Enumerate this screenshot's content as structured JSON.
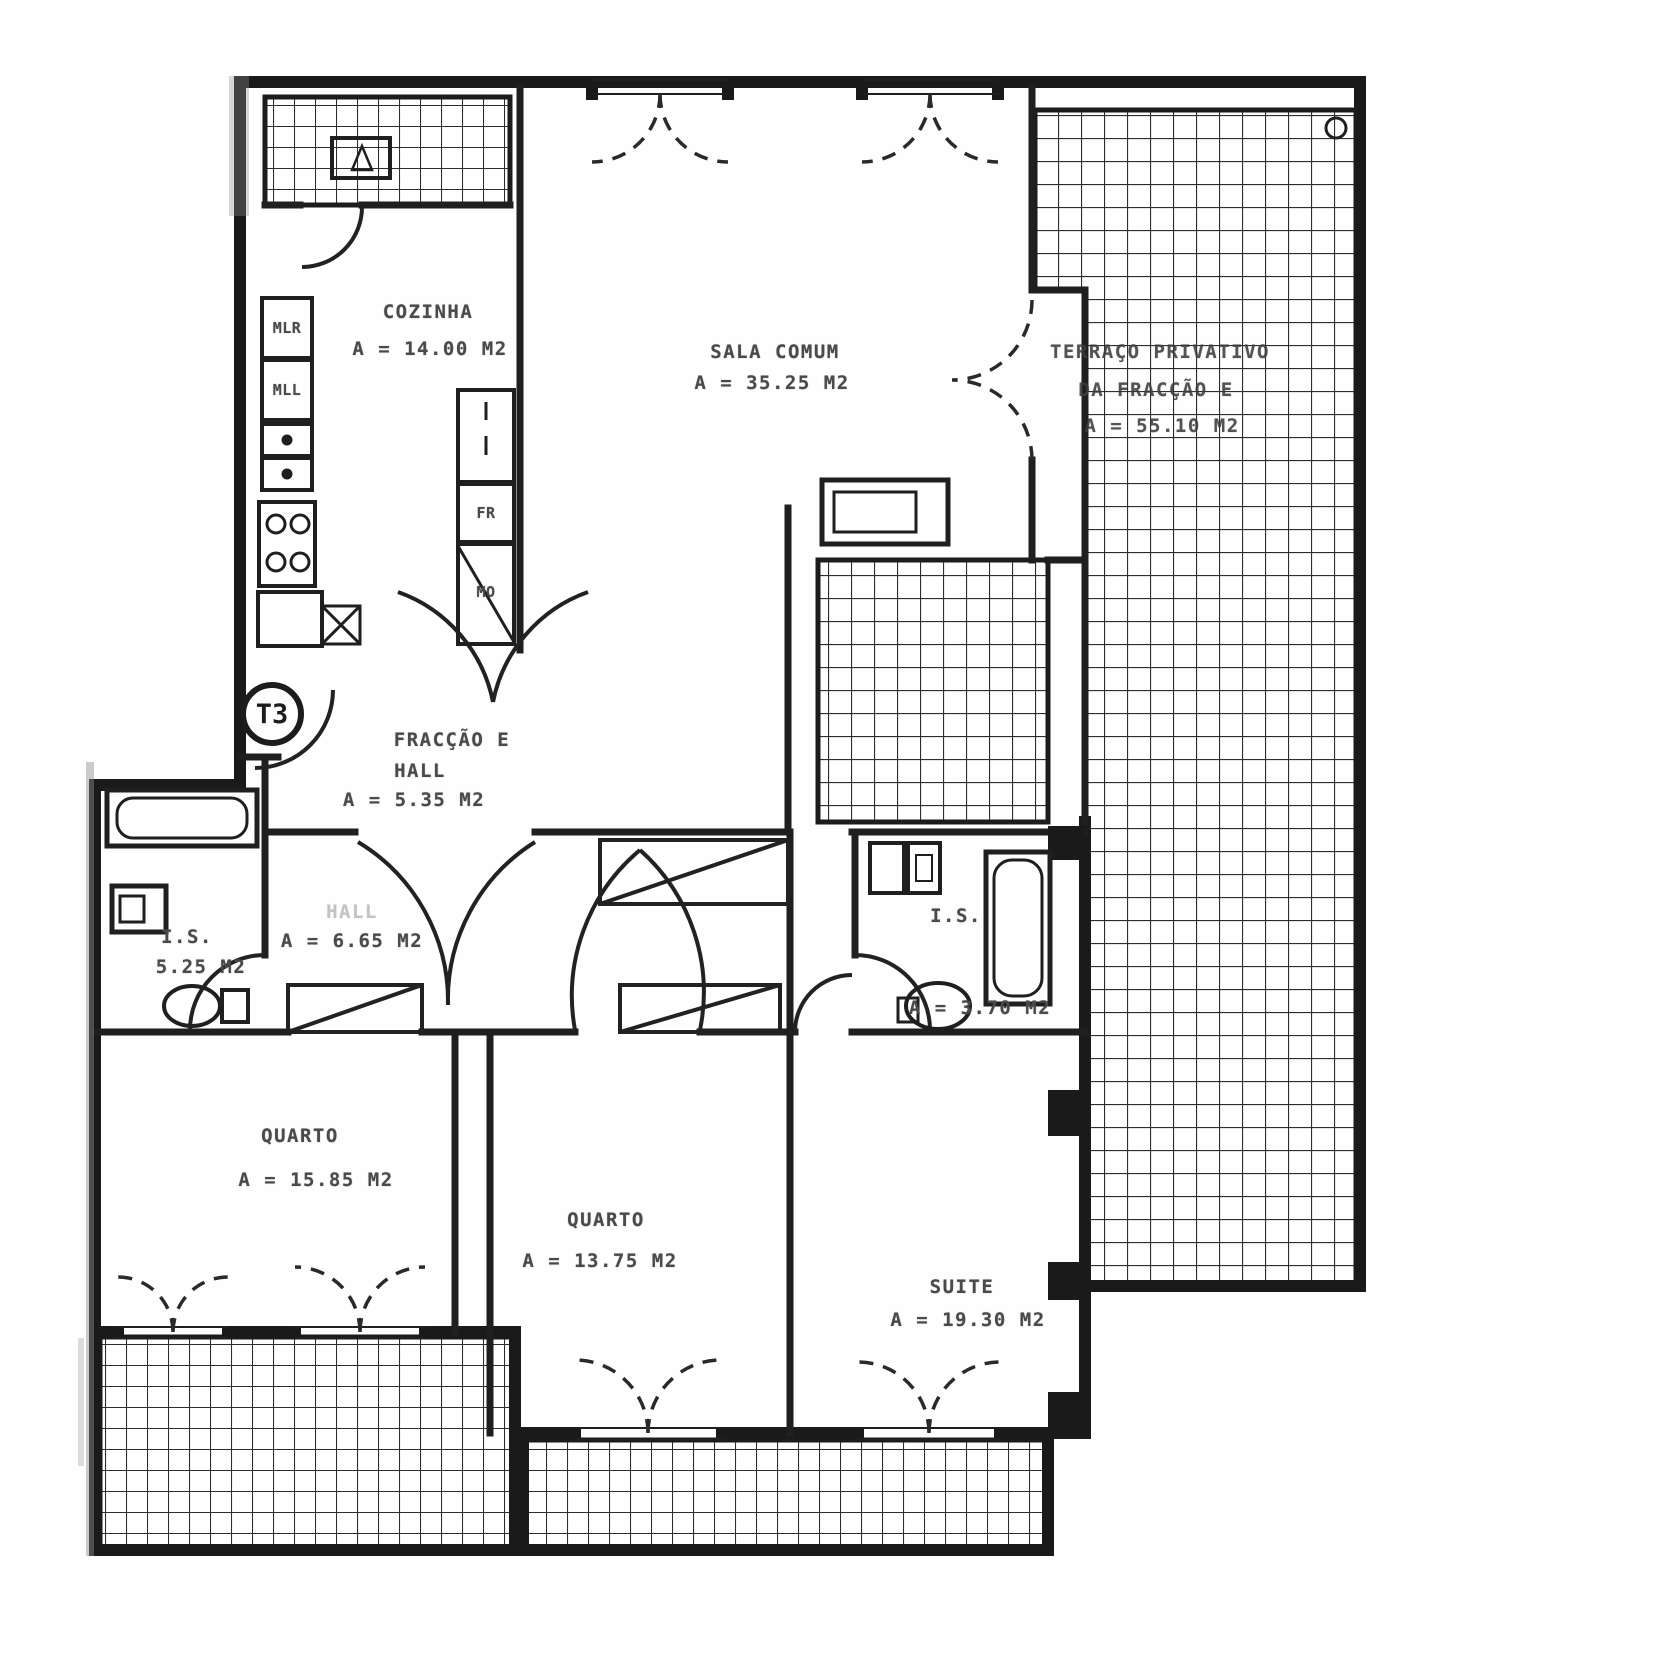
{
  "plan": {
    "badge": "T3",
    "rooms": {
      "cozinha": {
        "name": "COZINHA",
        "area": "A = 14.00 M2"
      },
      "sala": {
        "name": "SALA COMUM",
        "area": "A = 35.25 M2"
      },
      "terraco": {
        "name": "TERRAÇO PRIVATIVO",
        "name2": "DA FRACÇÃO E",
        "area": "A = 55.10 M2"
      },
      "fraccao": {
        "name": "FRACÇÃO E",
        "name2": "HALL",
        "area": "A = 5.35 M2"
      },
      "hall": {
        "name": "HALL",
        "area": "A = 6.65 M2"
      },
      "is_esq": {
        "name": "I.S.",
        "area": "5.25 M2"
      },
      "is_dir": {
        "name": "I.S.",
        "area": "A = 3.70 M2"
      },
      "quarto1": {
        "name": "QUARTO",
        "area": "A = 15.85 M2"
      },
      "quarto2": {
        "name": "QUARTO",
        "area": "A = 13.75 M2"
      },
      "suite": {
        "name": "SUITE",
        "area": "A = 19.30 M2"
      }
    },
    "appliances": {
      "mlr": "MLR",
      "mll": "MLL",
      "fr": "FR",
      "mo": "MO"
    },
    "colors": {
      "ink": "#1c1c1c",
      "label": "#4a4a4a",
      "paper": "#ffffff"
    }
  }
}
